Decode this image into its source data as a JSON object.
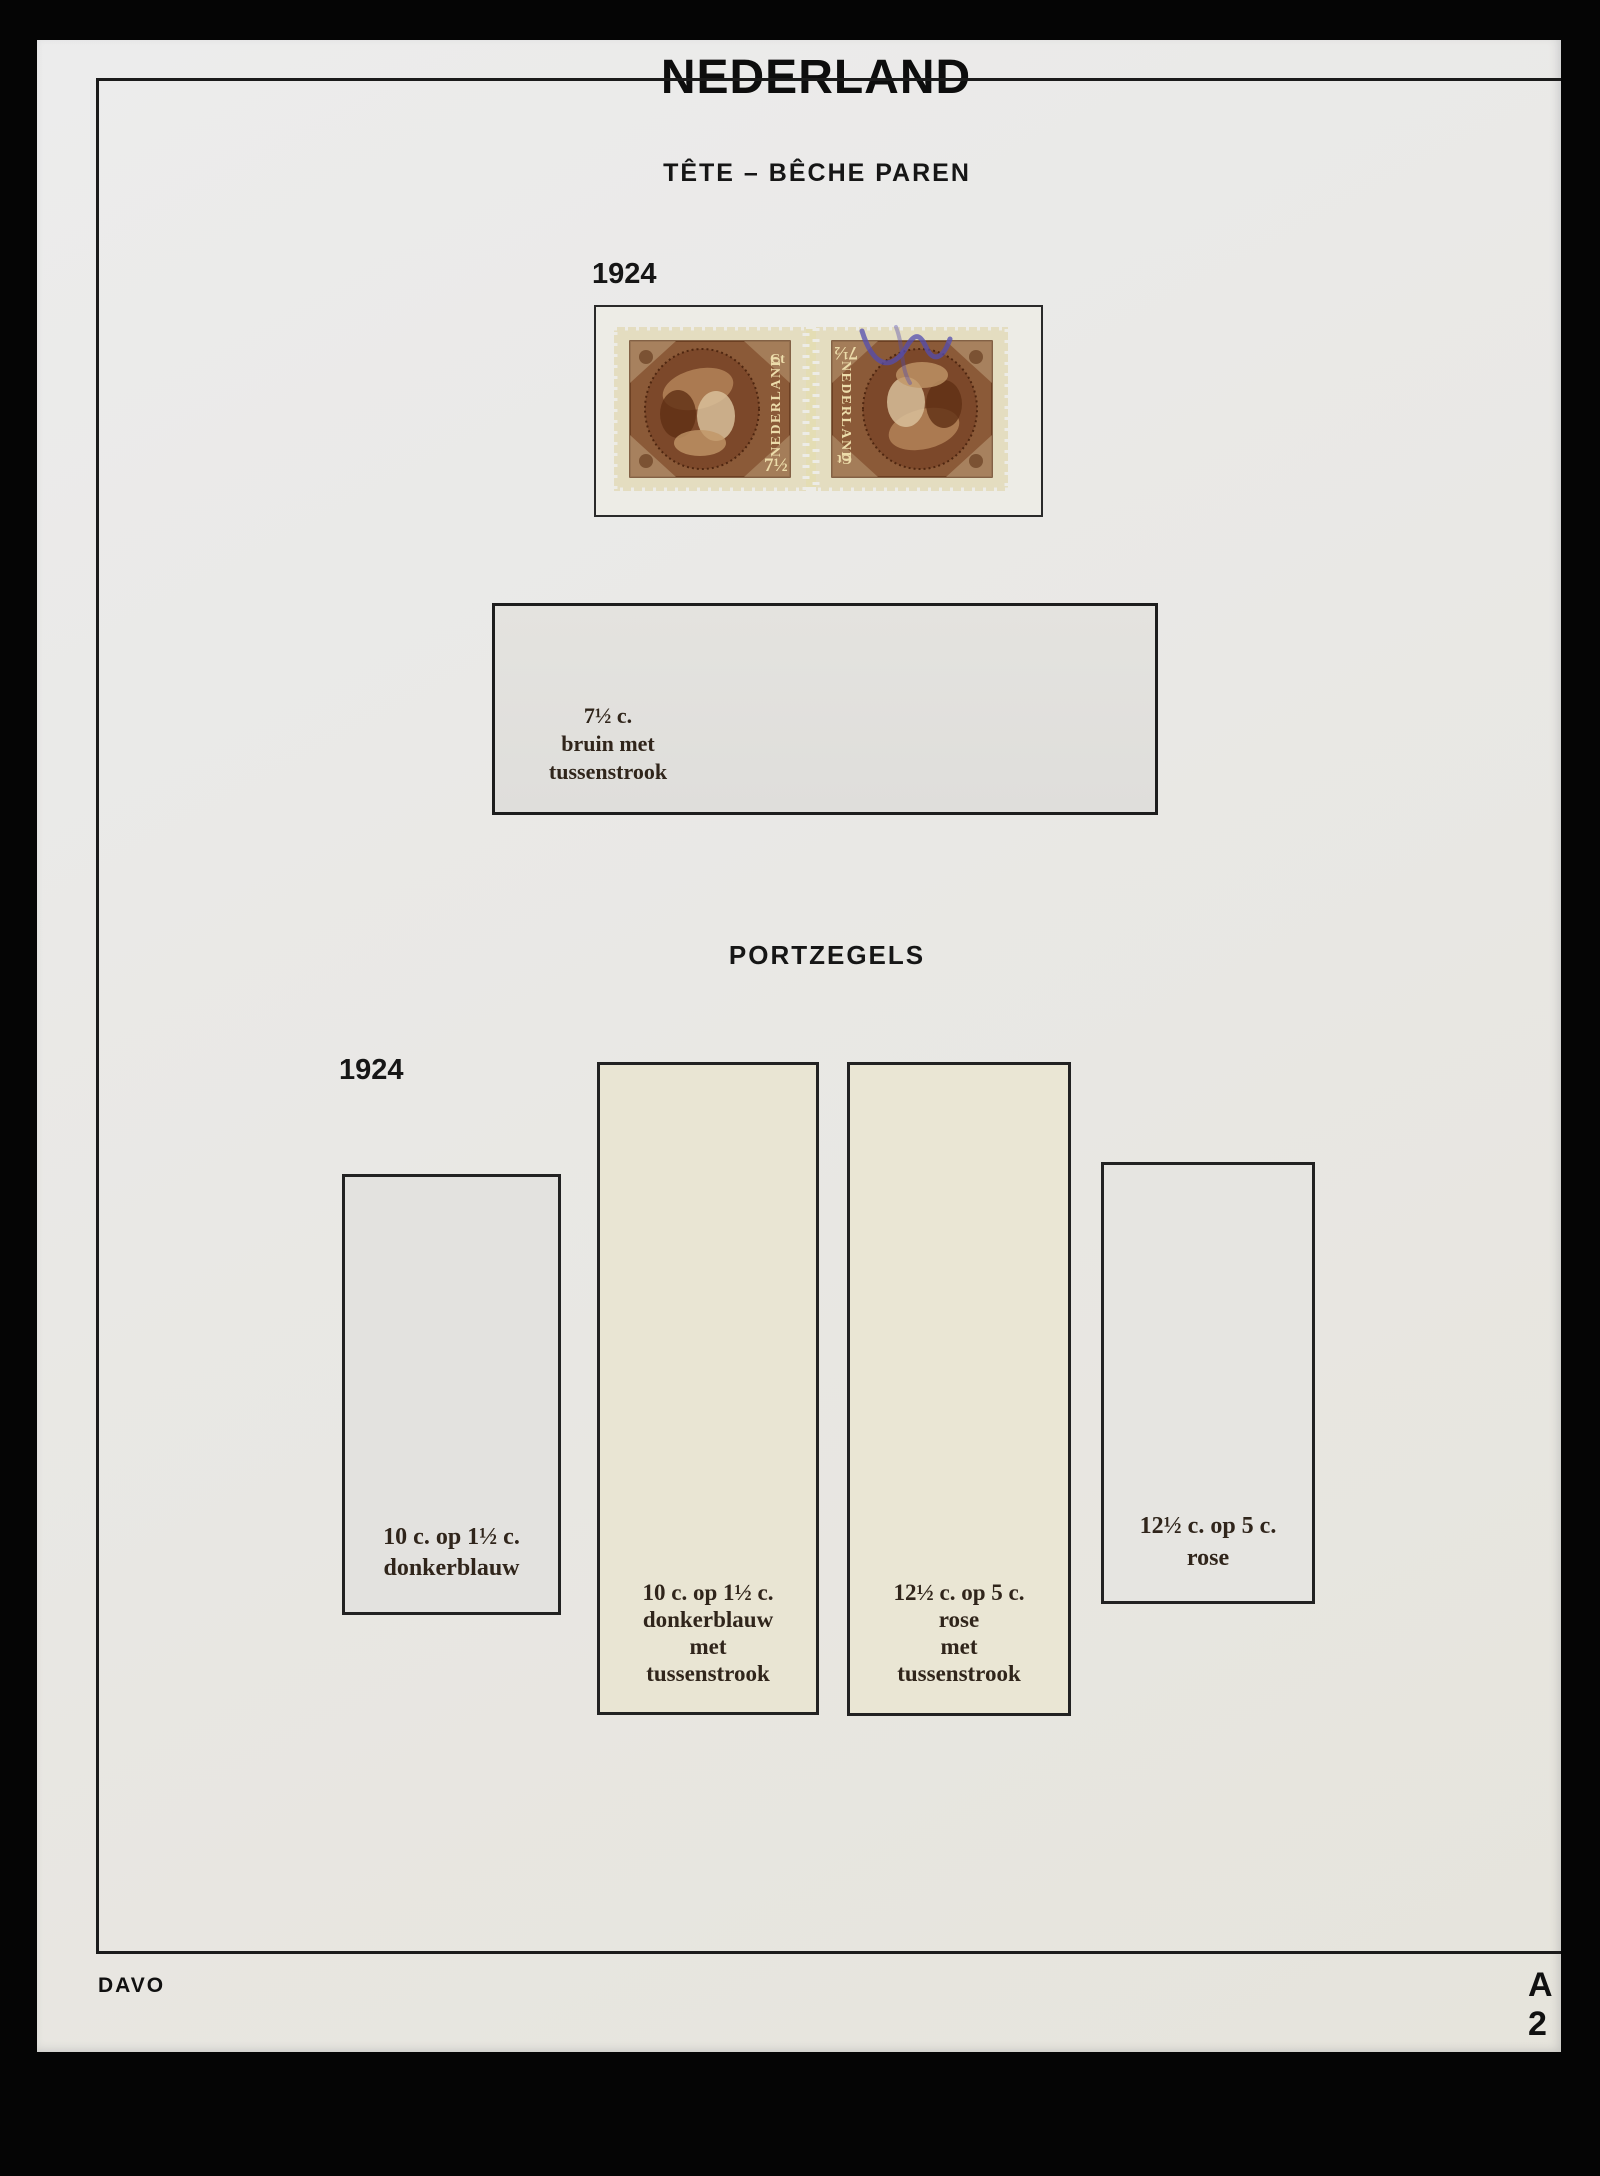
{
  "album": {
    "title": "NEDERLAND",
    "publisher": "DAVO",
    "page_code": "A 2"
  },
  "tete_beche": {
    "section_title": "TÊTE – BÊCHE PAREN",
    "year": "1924",
    "stamp_pair": {
      "country": "NEDERLAND",
      "denomination": "7½",
      "denomination_unit": "Ct"
    },
    "mount_label_lines": [
      "7½ c.",
      "bruin met",
      "tussenstrook"
    ]
  },
  "portzegels": {
    "section_title": "PORTZEGELS",
    "year": "1924",
    "mounts": [
      {
        "label_lines": [
          "10 c. op 1½ c.",
          "donkerblauw"
        ]
      },
      {
        "label_lines": [
          "10 c. op 1½ c.",
          "donkerblauw",
          "met",
          "tussenstrook"
        ]
      },
      {
        "label_lines": [
          "12½ c. op 5 c.",
          "rose",
          "met",
          "tussenstrook"
        ]
      },
      {
        "label_lines": [
          "12½ c. op 5 c.",
          "rose"
        ]
      }
    ]
  },
  "colors": {
    "backdrop": "#050505",
    "page": "#e8e8e6",
    "mount_gray": "#e3e2de",
    "mount_cream": "#e9e5d2",
    "stamp_brown": "#8b5a38",
    "stamp_paper": "#e4ddc0",
    "frame_ink": "#1b1b1b",
    "label_ink": "#30251b",
    "blue_mark": "#534cb0"
  }
}
